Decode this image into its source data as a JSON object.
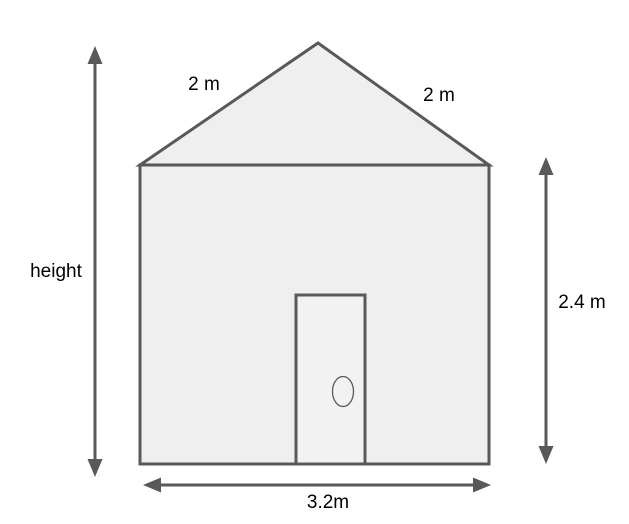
{
  "diagram": {
    "description": "house-dimensions-diagram",
    "labels": {
      "roof_left": "2 m",
      "roof_right": "2 m",
      "height": "height",
      "wall_height": "2.4 m",
      "base_width": "3.2m"
    },
    "colors": {
      "background": "#ffffff",
      "shape_fill": "#efefef",
      "door_fill": "#f2f2f2",
      "shape_stroke": "#595959",
      "text": "#000000"
    }
  }
}
